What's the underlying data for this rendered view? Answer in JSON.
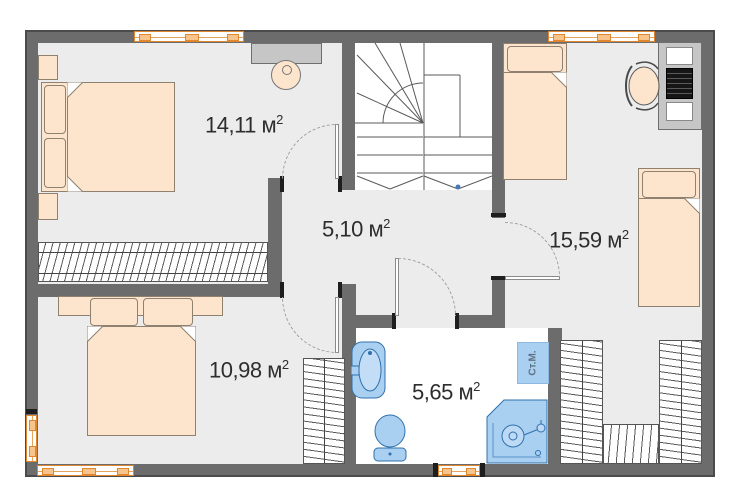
{
  "plan_type": "apartment-floor-plan",
  "rooms": {
    "bedroom_top_left": {
      "area": "14,11"
    },
    "hallway": {
      "area": "5,10"
    },
    "bedroom_right": {
      "area": "15,59"
    },
    "bedroom_bottom_left": {
      "area": "10,98"
    },
    "bathroom": {
      "area": "5,65"
    }
  },
  "units": {
    "meter": "м",
    "sup": "2"
  },
  "labels": {
    "washing_machine": "Ст.М."
  },
  "colors": {
    "wall": "#6c6c6c",
    "floor": "#ececec",
    "furniture_fill": "#fce4cd",
    "furniture_outline": "#8f8170",
    "fixture_fill": "#a9cff1",
    "fixture_outline": "#3071ad",
    "window_frame": "#e0862e",
    "label_text": "#2d2d2d",
    "marker_blue": "#4a7ab5"
  },
  "icons": [
    "double-bed",
    "single-bed",
    "pillow",
    "nightstand",
    "wardrobe",
    "stairs",
    "sink",
    "toilet",
    "shower",
    "washing-machine",
    "desk",
    "computer",
    "office-chair",
    "stool",
    "window",
    "door-swing"
  ]
}
